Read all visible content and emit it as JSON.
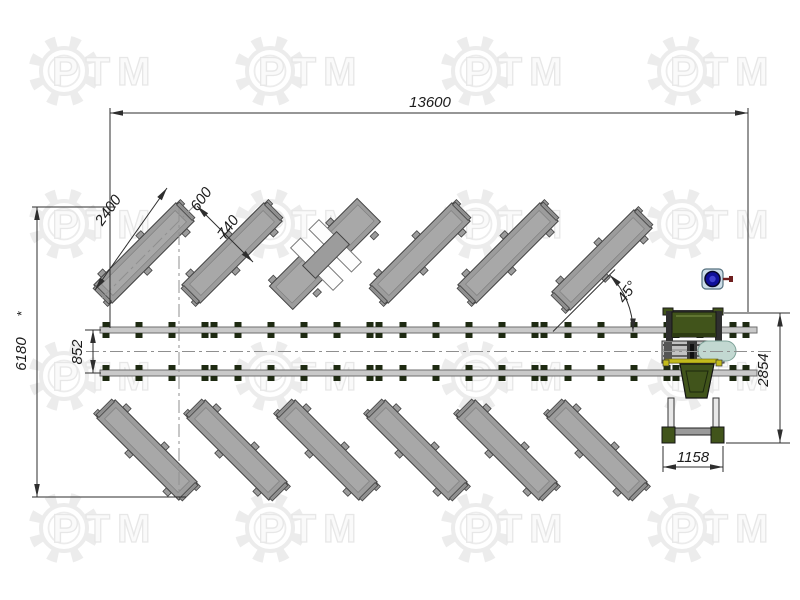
{
  "watermark": {
    "brand": "PTM"
  },
  "drawing": {
    "dimensions": {
      "overall_length": "13600",
      "overall_width": "6180",
      "overall_width_note": "*",
      "track_gap": "852",
      "conveyor_length": "2400",
      "spacing_a": "600",
      "spacing_b": "740",
      "angle": "45°",
      "machine_height": "2854",
      "machine_base": "1158"
    },
    "colors": {
      "line": "#2e2e2e",
      "rail": "#c9c9c9",
      "bolt": "#1e2a12",
      "conveyor": "#9c9c9c",
      "machine_green": "#41541b",
      "machine_green_dark": "#2c3a12",
      "accent_teal": "#c2d8d1",
      "accent_yellow": "#c3bb1c",
      "valve_blue": "#10109a",
      "valve_handle": "#6e1f1f",
      "watermark_gray": "#ececec"
    }
  }
}
